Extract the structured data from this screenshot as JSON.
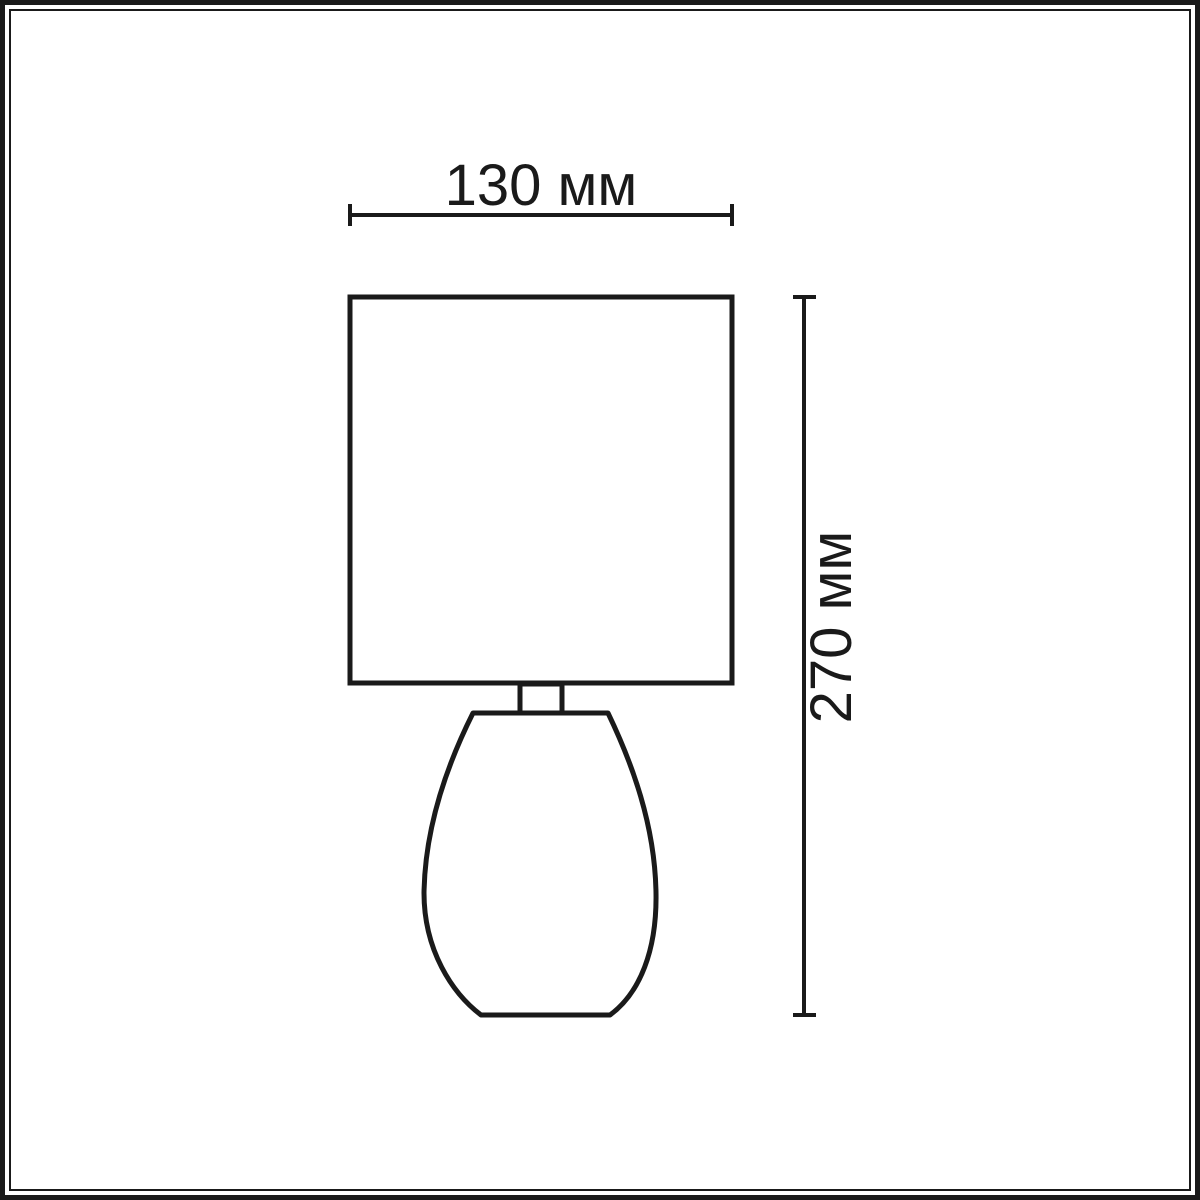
{
  "page": {
    "background_color": "#ffffff",
    "ink_color": "#1a1a1a"
  },
  "diagram": {
    "kind": "product dimension drawing",
    "subject": "table lamp with square shade and teardrop base",
    "width_dimension": {
      "label": "130 мм",
      "value": 130,
      "unit": "мм"
    },
    "height_dimension": {
      "label": "270 мм",
      "value": 270,
      "unit": "мм"
    }
  }
}
